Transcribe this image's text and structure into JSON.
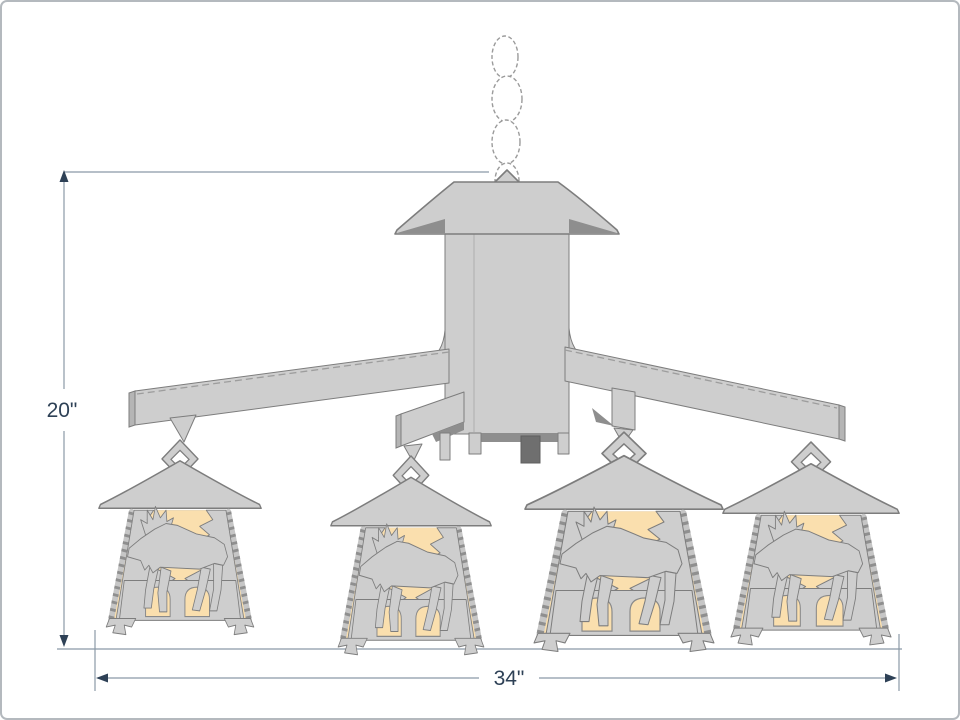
{
  "dimensions": {
    "height_label": "20\"",
    "width_label": "34\""
  },
  "fixture": {
    "lantern_count": 4,
    "motif": "moose"
  },
  "colors": {
    "background": "#ffffff",
    "frame_border": "#b4b9be",
    "metal_light": "#cecece",
    "metal_mid": "#b5b5b5",
    "metal_shadow": "#8e8e8e",
    "outline": "#7d7d7d",
    "glass": "#fadfae",
    "dimension_line": "#8b99a6",
    "dimension_text": "#2e4156"
  }
}
